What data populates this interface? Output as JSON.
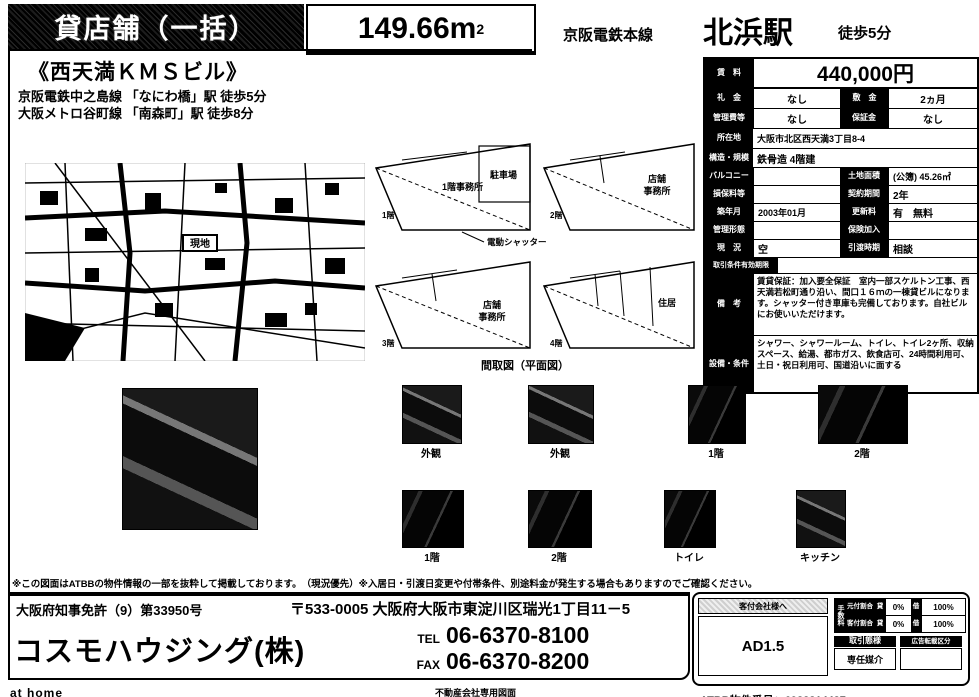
{
  "header": {
    "property_type": "貸店舗（一括）",
    "area_value": "149.66m",
    "area_sup": "2",
    "rail_line": "京阪電鉄本線",
    "station": "北浜駅",
    "walk": "徒歩5分"
  },
  "building": {
    "name": "《西天満ＫＭＳビル》",
    "access1": "京阪電鉄中之島線 「なにわ橋」駅 徒歩5分",
    "access2": "大阪メトロ谷町線 「南森町」駅 徒歩8分"
  },
  "map": {
    "marker": "現地"
  },
  "floorplan": {
    "section_label": "間取図（平面図）",
    "shutter_label": "電動シャッター",
    "plans": [
      {
        "floor": "1階",
        "room": "1階事務所",
        "sub": "駐車場"
      },
      {
        "floor": "2階",
        "room": "店舗",
        "room2": "事務所"
      },
      {
        "floor": "3階",
        "room": "店舗",
        "room2": "事務所"
      },
      {
        "floor": "4階",
        "room": "住居"
      }
    ]
  },
  "info_table": {
    "rent": {
      "label": "賃　料",
      "value": "440,000円"
    },
    "row2": {
      "l1": "礼　金",
      "v1": "なし",
      "l2": "敷　金",
      "v2": "2ヵ月"
    },
    "row3": {
      "l1": "管理費等",
      "v1": "なし",
      "l2": "保証金",
      "v2": "なし"
    },
    "address": {
      "label": "所在地",
      "value": "大阪市北区西天満3丁目8-4"
    },
    "structure": {
      "label": "構造・規模",
      "value": "鉄骨造 4階建"
    },
    "row6": {
      "l1": "バルコニー",
      "v1": "",
      "l2": "土地面積",
      "v2": "(公簿) 45.26㎡"
    },
    "row7": {
      "l1": "損保料等",
      "v1": "",
      "l2": "契約期間",
      "v2": "2年"
    },
    "row8": {
      "l1": "築年月",
      "v1": "2003年01月",
      "l2": "更新料",
      "v2": "有　無料"
    },
    "row9": {
      "l1": "管理形態",
      "v1": "",
      "l2": "保険加入",
      "v2": ""
    },
    "row10": {
      "l1": "現　況",
      "v1": "空",
      "l2": "引渡時期",
      "v2": "相談"
    },
    "row11": {
      "label": "取引条件有効期限",
      "value": ""
    },
    "remarks": {
      "label": "備　考",
      "value": "賃貸保証：加入要全保証　室内一部スケルトン工事、西天満若松町通り沿い、間口１６ｍの一棟貸ビルになります。シャッター付き車庫も完備しております。自社ビルにお使いいただけます。"
    },
    "equipment": {
      "label": "設備・条件",
      "value": "シャワー、シャワールーム、トイレ、トイレ2ヶ所、収納スペース、給湯、都市ガス、飲食店可、24時間利用可、土日・祝日利用可、国道沿いに面する"
    }
  },
  "photos": {
    "row1": [
      {
        "caption": "外観"
      },
      {
        "caption": "外観"
      },
      {
        "caption": "1階"
      },
      {
        "caption": "2階"
      }
    ],
    "row2": [
      {
        "caption": "1階"
      },
      {
        "caption": "2階"
      },
      {
        "caption": "トイレ"
      },
      {
        "caption": "キッチン"
      }
    ]
  },
  "disclaimer": "※この図面はATBBの物件情報の一部を抜粋して掲載しております。　（現況優先）※入居日・引渡日変更や付帯条件、別途料金が発生する場合もありますのでご確認ください。",
  "footer": {
    "license": "大阪府知事免許（9）第33950号",
    "company": "コスモハウジング(株)",
    "address": "〒533-0005 大阪府大阪市東淀川区瑞光1丁目11－5",
    "tel_label": "TEL",
    "tel": "06-6370-8100",
    "fax_label": "FAX",
    "fax": "06-6370-8200",
    "athome": "at home",
    "drawing_note": "不動産会社専用図面",
    "atbb_number": "ATBB物件番号：6982814427",
    "broker_box": {
      "header": "客付会社様へ",
      "ad": "AD1.5",
      "fee_label": "手数料",
      "fee_rows": [
        {
          "name": "元付割合",
          "l1": "貸",
          "v1": "0%",
          "l2": "借",
          "v2": "100%"
        },
        {
          "name": "客付割合",
          "l1": "貸",
          "v1": "0%",
          "l2": "借",
          "v2": "100%"
        }
      ],
      "deal_label": "取引態様",
      "deal_value": "専任媒介",
      "ad_label": "広告転載区分",
      "ad_value": ""
    }
  }
}
